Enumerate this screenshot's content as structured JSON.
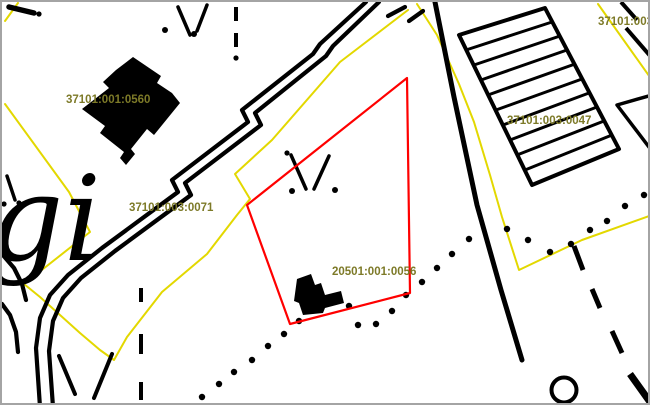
{
  "map": {
    "labels": {
      "parcel_0560": "37101:001:0560",
      "parcel_0071": "37101:003:0071",
      "parcel_0047": "37101:003:0047",
      "parcel_top_right": "37101:003",
      "parcel_selected": "20501:001:0056",
      "place_name_fragment": "gi"
    },
    "colors": {
      "cadastral_boundary": "#e3d800",
      "selected_parcel_outline": "#ff0000",
      "label_text": "#7d7a28",
      "map_feature_black": "#000000",
      "background": "#ffffff",
      "frame_border": "#a4a4a4"
    }
  }
}
